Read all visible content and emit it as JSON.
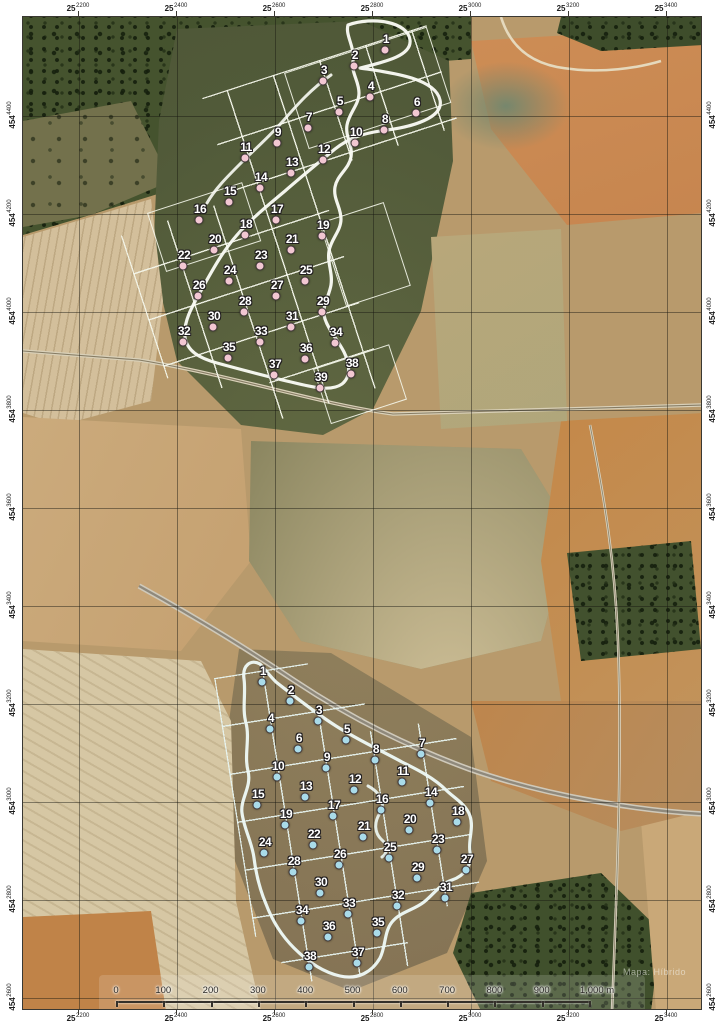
{
  "map": {
    "watermark": "Mapa: Híbrido",
    "coordinate_labels": {
      "eastings": [
        {
          "prefix": "25",
          "digits": "2200"
        },
        {
          "prefix": "25",
          "digits": "2400"
        },
        {
          "prefix": "25",
          "digits": "2600"
        },
        {
          "prefix": "25",
          "digits": "2800"
        },
        {
          "prefix": "25",
          "digits": "3000"
        },
        {
          "prefix": "25",
          "digits": "3200"
        },
        {
          "prefix": "25",
          "digits": "3400"
        }
      ],
      "northings": [
        {
          "prefix": "454",
          "digits": "4400"
        },
        {
          "prefix": "454",
          "digits": "4200"
        },
        {
          "prefix": "454",
          "digits": "4000"
        },
        {
          "prefix": "454",
          "digits": "3800"
        },
        {
          "prefix": "454",
          "digits": "3600"
        },
        {
          "prefix": "454",
          "digits": "3400"
        },
        {
          "prefix": "454",
          "digits": "3200"
        },
        {
          "prefix": "454",
          "digits": "3000"
        },
        {
          "prefix": "454",
          "digits": "2800"
        },
        {
          "prefix": "454",
          "digits": "2600"
        }
      ]
    },
    "scale_bar": {
      "tick_labels": [
        "0",
        "100",
        "200",
        "300",
        "400",
        "500",
        "600",
        "700",
        "800",
        "900"
      ],
      "end_label": "1,000 m"
    },
    "surveys": {
      "north": {
        "dot_color": "#f2c7d2",
        "points": [
          {
            "n": "1",
            "x": 384,
            "y": 49
          },
          {
            "n": "2",
            "x": 353,
            "y": 65
          },
          {
            "n": "3",
            "x": 322,
            "y": 80
          },
          {
            "n": "4",
            "x": 369,
            "y": 96
          },
          {
            "n": "5",
            "x": 338,
            "y": 111
          },
          {
            "n": "6",
            "x": 415,
            "y": 112
          },
          {
            "n": "7",
            "x": 307,
            "y": 127
          },
          {
            "n": "8",
            "x": 383,
            "y": 129
          },
          {
            "n": "9",
            "x": 276,
            "y": 142
          },
          {
            "n": "10",
            "x": 354,
            "y": 142
          },
          {
            "n": "11",
            "x": 244,
            "y": 157
          },
          {
            "n": "12",
            "x": 322,
            "y": 159
          },
          {
            "n": "13",
            "x": 290,
            "y": 172
          },
          {
            "n": "14",
            "x": 259,
            "y": 187
          },
          {
            "n": "15",
            "x": 228,
            "y": 201
          },
          {
            "n": "16",
            "x": 198,
            "y": 219
          },
          {
            "n": "17",
            "x": 275,
            "y": 219
          },
          {
            "n": "18",
            "x": 244,
            "y": 234
          },
          {
            "n": "19",
            "x": 321,
            "y": 235
          },
          {
            "n": "20",
            "x": 213,
            "y": 249
          },
          {
            "n": "21",
            "x": 290,
            "y": 249
          },
          {
            "n": "22",
            "x": 182,
            "y": 265
          },
          {
            "n": "23",
            "x": 259,
            "y": 265
          },
          {
            "n": "24",
            "x": 228,
            "y": 280
          },
          {
            "n": "25",
            "x": 304,
            "y": 280
          },
          {
            "n": "26",
            "x": 197,
            "y": 295
          },
          {
            "n": "27",
            "x": 275,
            "y": 295
          },
          {
            "n": "28",
            "x": 243,
            "y": 311
          },
          {
            "n": "29",
            "x": 321,
            "y": 311
          },
          {
            "n": "30",
            "x": 212,
            "y": 326
          },
          {
            "n": "31",
            "x": 290,
            "y": 326
          },
          {
            "n": "32",
            "x": 182,
            "y": 341
          },
          {
            "n": "33",
            "x": 259,
            "y": 341
          },
          {
            "n": "34",
            "x": 334,
            "y": 342
          },
          {
            "n": "35",
            "x": 227,
            "y": 357
          },
          {
            "n": "36",
            "x": 304,
            "y": 358
          },
          {
            "n": "37",
            "x": 273,
            "y": 374
          },
          {
            "n": "38",
            "x": 350,
            "y": 373
          },
          {
            "n": "39",
            "x": 319,
            "y": 387
          }
        ]
      },
      "south": {
        "dot_color": "#a9dbe9",
        "points": [
          {
            "n": "1",
            "x": 261,
            "y": 681
          },
          {
            "n": "2",
            "x": 289,
            "y": 700
          },
          {
            "n": "3",
            "x": 317,
            "y": 720
          },
          {
            "n": "4",
            "x": 269,
            "y": 728
          },
          {
            "n": "5",
            "x": 345,
            "y": 739
          },
          {
            "n": "6",
            "x": 297,
            "y": 748
          },
          {
            "n": "7",
            "x": 420,
            "y": 753
          },
          {
            "n": "8",
            "x": 374,
            "y": 759
          },
          {
            "n": "9",
            "x": 325,
            "y": 767
          },
          {
            "n": "10",
            "x": 276,
            "y": 776
          },
          {
            "n": "11",
            "x": 401,
            "y": 781
          },
          {
            "n": "12",
            "x": 353,
            "y": 789
          },
          {
            "n": "13",
            "x": 304,
            "y": 796
          },
          {
            "n": "14",
            "x": 429,
            "y": 802
          },
          {
            "n": "15",
            "x": 256,
            "y": 804
          },
          {
            "n": "16",
            "x": 380,
            "y": 809
          },
          {
            "n": "17",
            "x": 332,
            "y": 815
          },
          {
            "n": "18",
            "x": 456,
            "y": 821
          },
          {
            "n": "19",
            "x": 284,
            "y": 824
          },
          {
            "n": "20",
            "x": 408,
            "y": 829
          },
          {
            "n": "21",
            "x": 362,
            "y": 836
          },
          {
            "n": "22",
            "x": 312,
            "y": 844
          },
          {
            "n": "23",
            "x": 436,
            "y": 849
          },
          {
            "n": "24",
            "x": 263,
            "y": 852
          },
          {
            "n": "25",
            "x": 388,
            "y": 857
          },
          {
            "n": "26",
            "x": 338,
            "y": 864
          },
          {
            "n": "27",
            "x": 465,
            "y": 869
          },
          {
            "n": "28",
            "x": 292,
            "y": 871
          },
          {
            "n": "29",
            "x": 416,
            "y": 877
          },
          {
            "n": "30",
            "x": 319,
            "y": 892
          },
          {
            "n": "31",
            "x": 444,
            "y": 897
          },
          {
            "n": "32",
            "x": 396,
            "y": 905
          },
          {
            "n": "33",
            "x": 347,
            "y": 913
          },
          {
            "n": "34",
            "x": 300,
            "y": 920
          },
          {
            "n": "35",
            "x": 376,
            "y": 932
          },
          {
            "n": "36",
            "x": 327,
            "y": 936
          },
          {
            "n": "37",
            "x": 356,
            "y": 962
          },
          {
            "n": "38",
            "x": 308,
            "y": 966
          }
        ]
      }
    }
  }
}
